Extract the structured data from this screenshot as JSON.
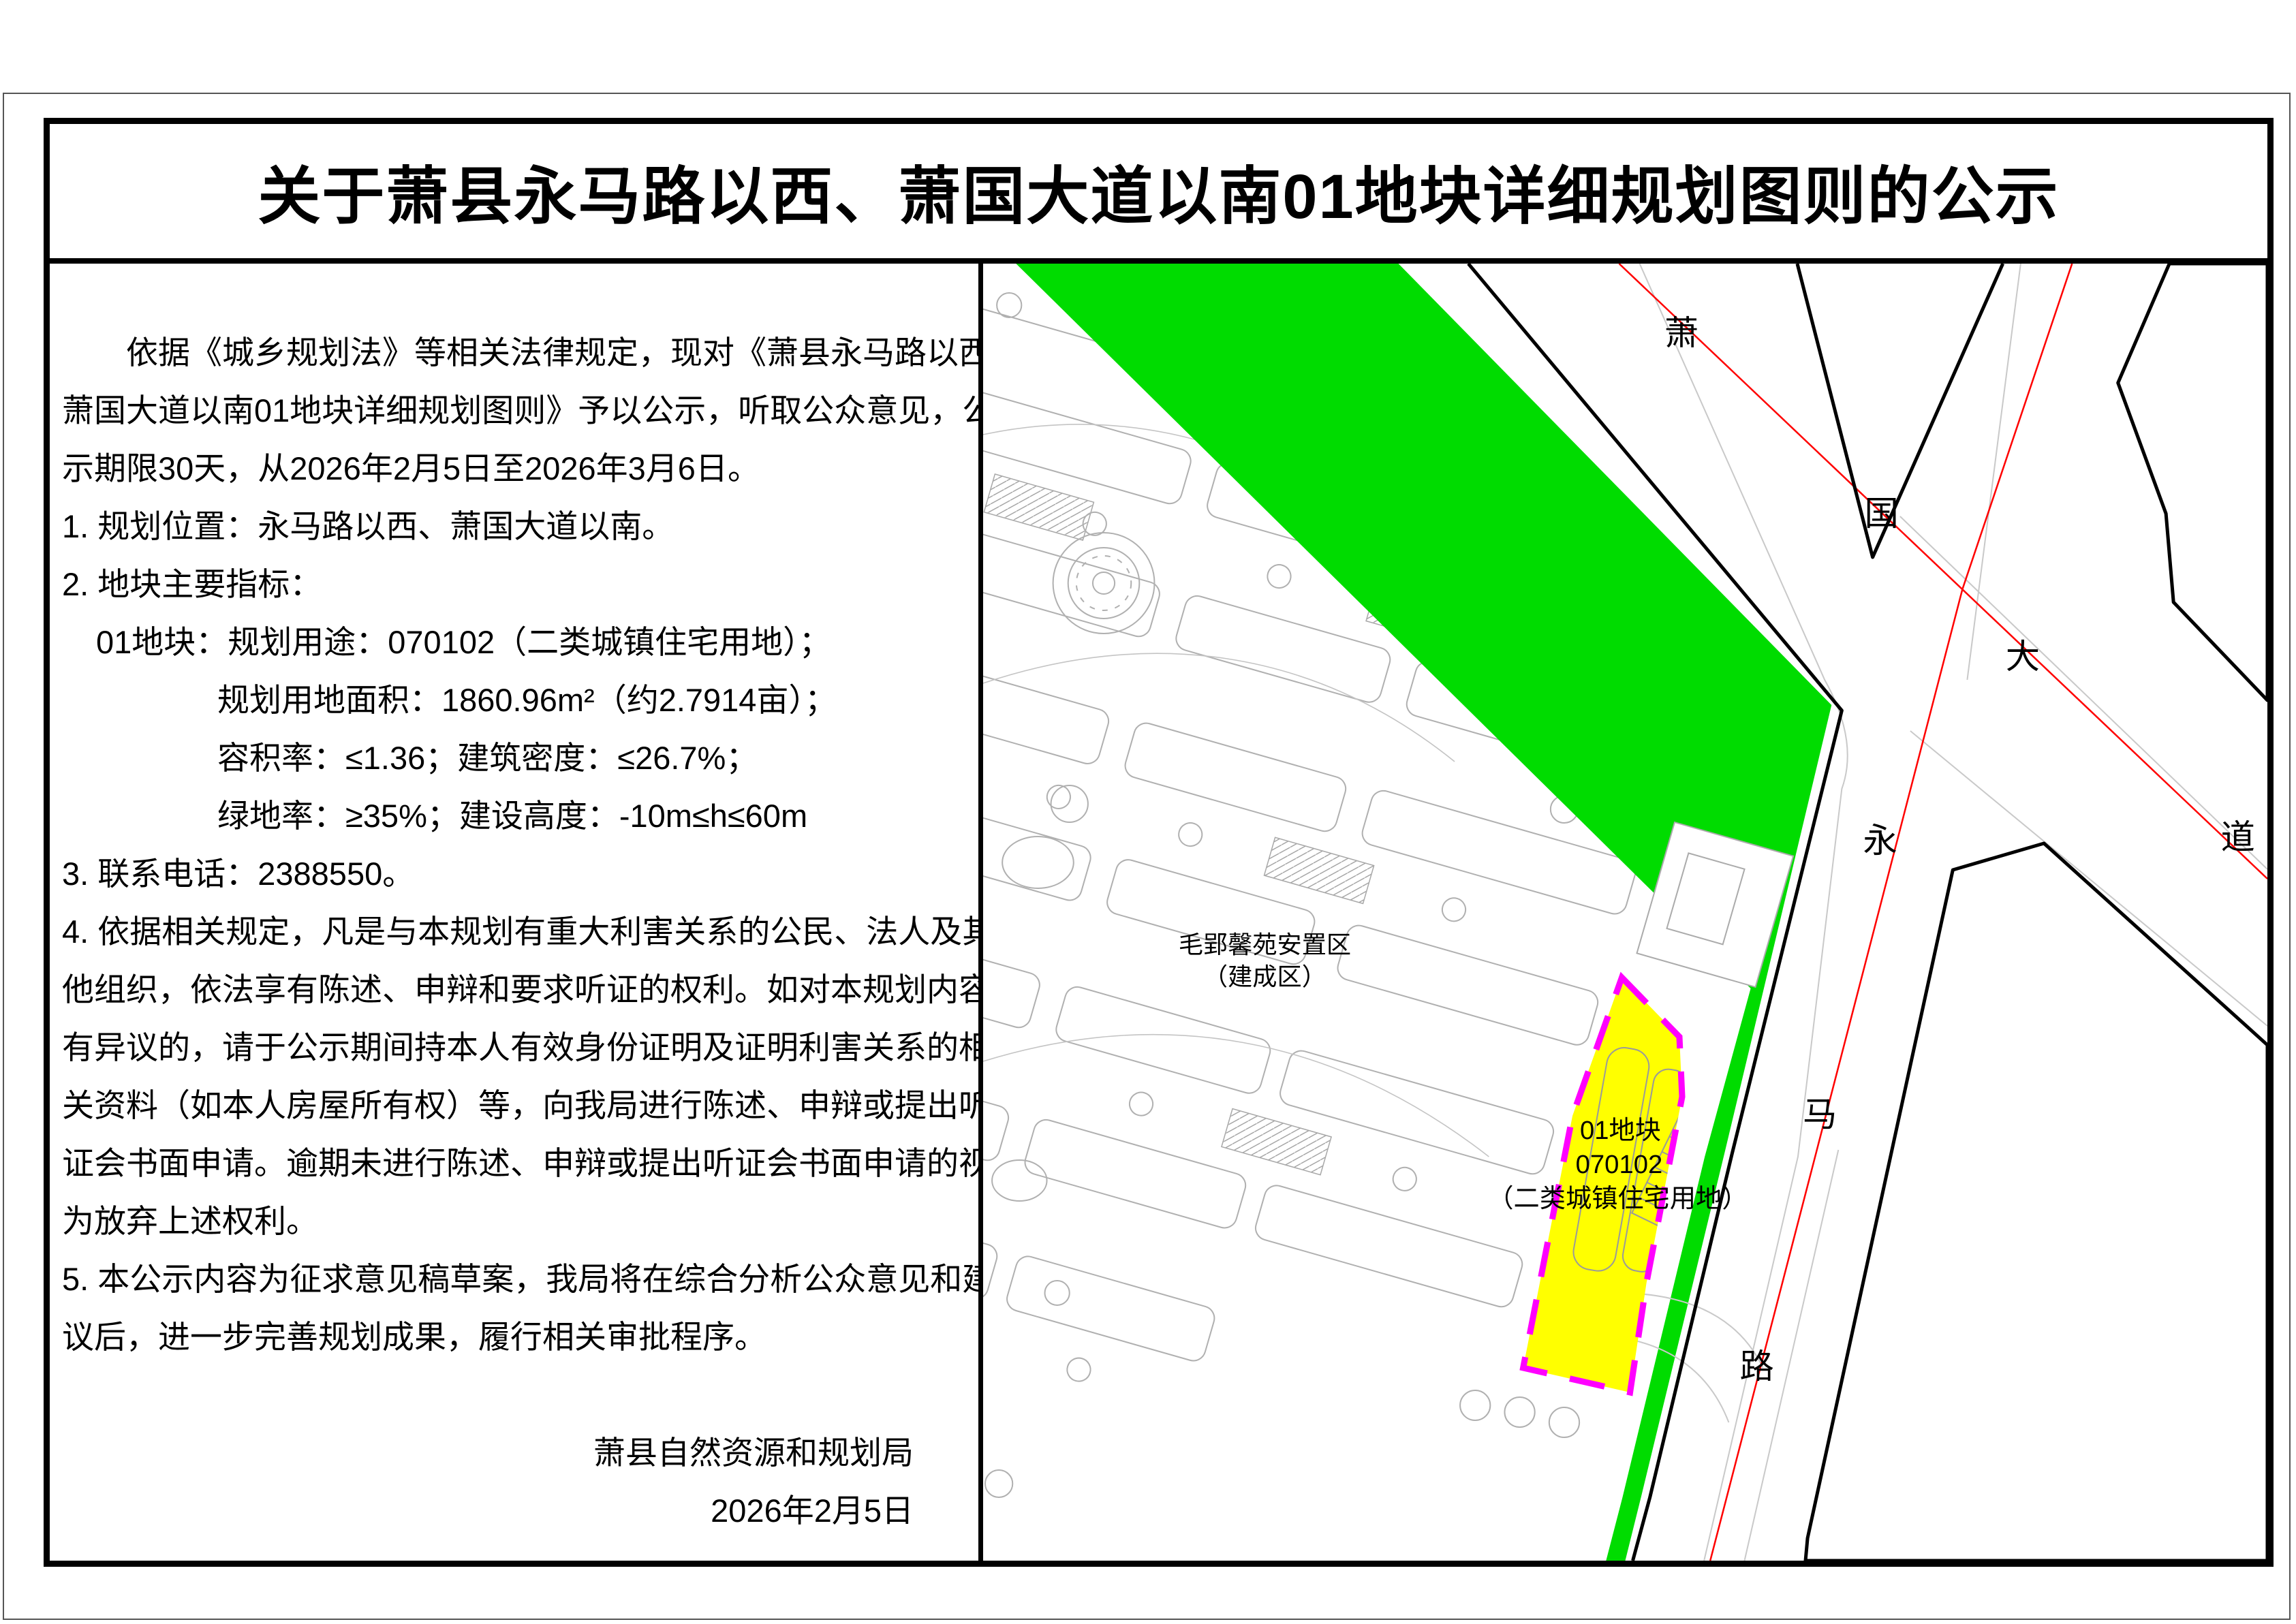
{
  "page": {
    "title": "关于萧县永马路以西、萧国大道以南01地块详细规划图则的公示"
  },
  "notice": {
    "lines": [
      {
        "text": "依据《城乡规划法》等相关法律规定，现对《萧县永马路以西、"
      },
      {
        "text": "萧国大道以南01地块详细规划图则》予以公示，听取公众意见，公"
      },
      {
        "text": "示期限30天，从2026年2月5日至2026年3月6日。"
      },
      {
        "text": "1. 规划位置：永马路以西、萧国大道以南。"
      },
      {
        "text": "2. 地块主要指标："
      },
      {
        "text": "01地块：规划用途：070102（二类城镇住宅用地）；"
      },
      {
        "text": "规划用地面积：1860.96m²（约2.7914亩）；"
      },
      {
        "text": "容积率：≤1.36；建筑密度：≤26.7%；"
      },
      {
        "text": "绿地率：≥35%；建设高度：-10m≤h≤60m"
      },
      {
        "text": "3. 联系电话：2388550。"
      },
      {
        "text": "4. 依据相关规定，凡是与本规划有重大利害关系的公民、法人及其"
      },
      {
        "text": "他组织，依法享有陈述、申辩和要求听证的权利。如对本规划内容"
      },
      {
        "text": "有异议的，请于公示期间持本人有效身份证明及证明利害关系的相"
      },
      {
        "text": "关资料（如本人房屋所有权）等，向我局进行陈述、申辩或提出听"
      },
      {
        "text": "证会书面申请。逾期未进行陈述、申辩或提出听证会书面申请的视"
      },
      {
        "text": "为放弃上述权利。"
      },
      {
        "text": "5. 本公示内容为征求意见稿草案，我局将在综合分析公众意见和建"
      },
      {
        "text": "议后，进一步完善规划成果，履行相关审批程序。"
      },
      {
        "text": ""
      },
      {
        "text": "萧县自然资源和规划局"
      },
      {
        "text": "2026年2月5日"
      }
    ]
  },
  "map": {
    "roads": {
      "xiaoguo_dadao": "萧国大道",
      "yongma_lu": "永马路"
    },
    "district": {
      "line1": "毛郢馨苑安置区",
      "line2": "（建成区）"
    },
    "plot": {
      "line1": "01地块",
      "line2": "070102",
      "line3": "（二类城镇住宅用地）"
    },
    "colors": {
      "green_belt": "#00DC00",
      "plot_fill": "#FFFF00",
      "plot_boundary": "#FF00FF",
      "road_centerline": "#FF0000"
    }
  }
}
